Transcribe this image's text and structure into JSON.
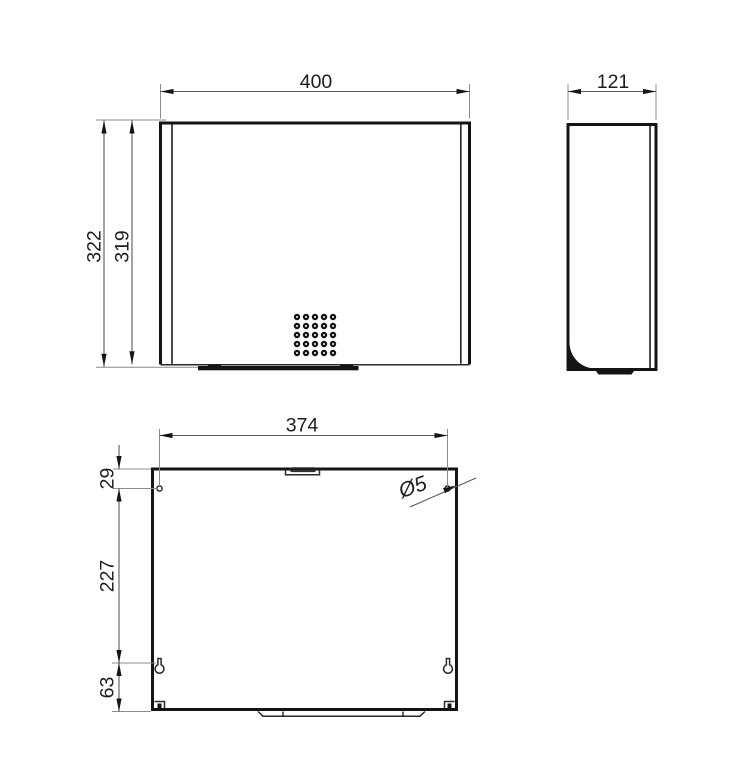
{
  "drawing": {
    "type": "technical-dimension-drawing",
    "views": {
      "front": {
        "width": "400",
        "height_overall": "322",
        "height_cover": "319"
      },
      "side": {
        "depth": "121"
      },
      "back": {
        "hole_spacing": "374",
        "top_to_hole": "29",
        "hole_to_keyhole": "227",
        "keyhole_to_bottom": "63",
        "hole_diameter": "Ø5"
      }
    },
    "colors": {
      "line": "#141414",
      "dimension_line": "#5a5a5a",
      "extension_line": "#8c8c8c",
      "background": "#ffffff"
    }
  }
}
